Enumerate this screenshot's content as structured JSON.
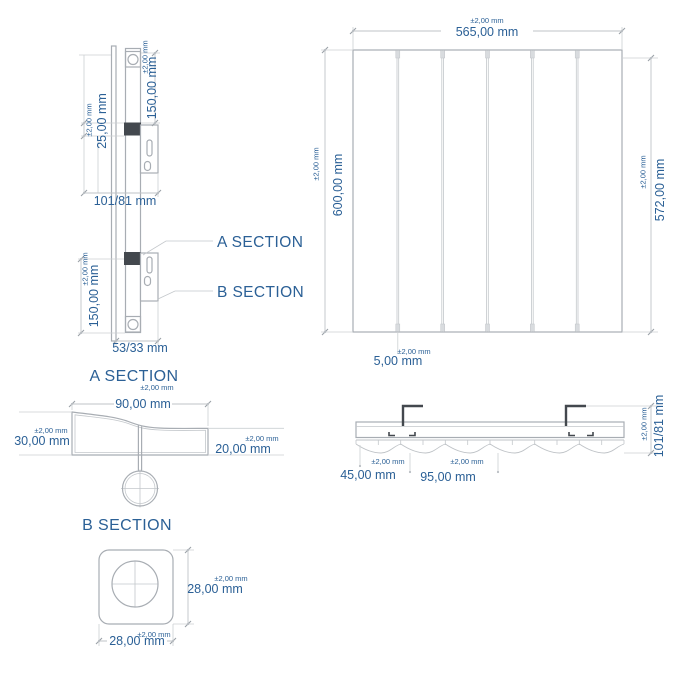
{
  "drawing": {
    "colors": {
      "dimension_text_blue": "#2b6096",
      "drawing_line_gray": "#a8adb3",
      "dark_detail_gray": "#43484e",
      "background": "#ffffff"
    },
    "side_view": {
      "dim_top_height": {
        "tolerance": "±2,00 mm",
        "value": "150,00 mm"
      },
      "dim_bracket_height": {
        "tolerance": "±2,00 mm",
        "value": "25,00 mm"
      },
      "dim_depth_top": {
        "value": "101/81 mm"
      },
      "dim_bottom_height": {
        "tolerance": "±2,00 mm",
        "value": "150,00 mm"
      },
      "dim_depth_bottom": {
        "value": "53/33 mm"
      },
      "label_a_section": "A SECTION",
      "label_b_section": "B SECTION"
    },
    "front_view": {
      "slat_count": 6,
      "dim_width": {
        "tolerance": "±2,00 mm",
        "value": "565,00 mm"
      },
      "dim_height": {
        "tolerance": "±2,00 mm",
        "value": "600,00 mm"
      },
      "dim_inner_height": {
        "tolerance": "±2,00 mm",
        "value": "572,00 mm"
      },
      "dim_gap": {
        "tolerance": "±2,00 mm",
        "value": "5,00 mm"
      }
    },
    "section_a": {
      "title": "A SECTION",
      "dim_width": {
        "tolerance": "±2,00 mm",
        "value": "90,00 mm"
      },
      "dim_left_height": {
        "tolerance": "±2,00 mm",
        "value": "30,00 mm"
      },
      "dim_right_height": {
        "tolerance": "±2,00 mm",
        "value": "20,00 mm"
      }
    },
    "top_view": {
      "dim_bracket_offset": {
        "tolerance": "±2,00 mm",
        "value": "45,00 mm"
      },
      "dim_bracket_spacing": {
        "tolerance": "±2,00 mm",
        "value": "95,00 mm"
      },
      "dim_depth": {
        "tolerance": "±2,00 mm",
        "value": "101/81 mm"
      }
    },
    "section_b": {
      "title": "B SECTION",
      "dim_height": {
        "tolerance": "±2,00 mm",
        "value": "28,00 mm"
      },
      "dim_width": {
        "tolerance": "±2,00 mm",
        "value": "28,00 mm"
      }
    }
  }
}
